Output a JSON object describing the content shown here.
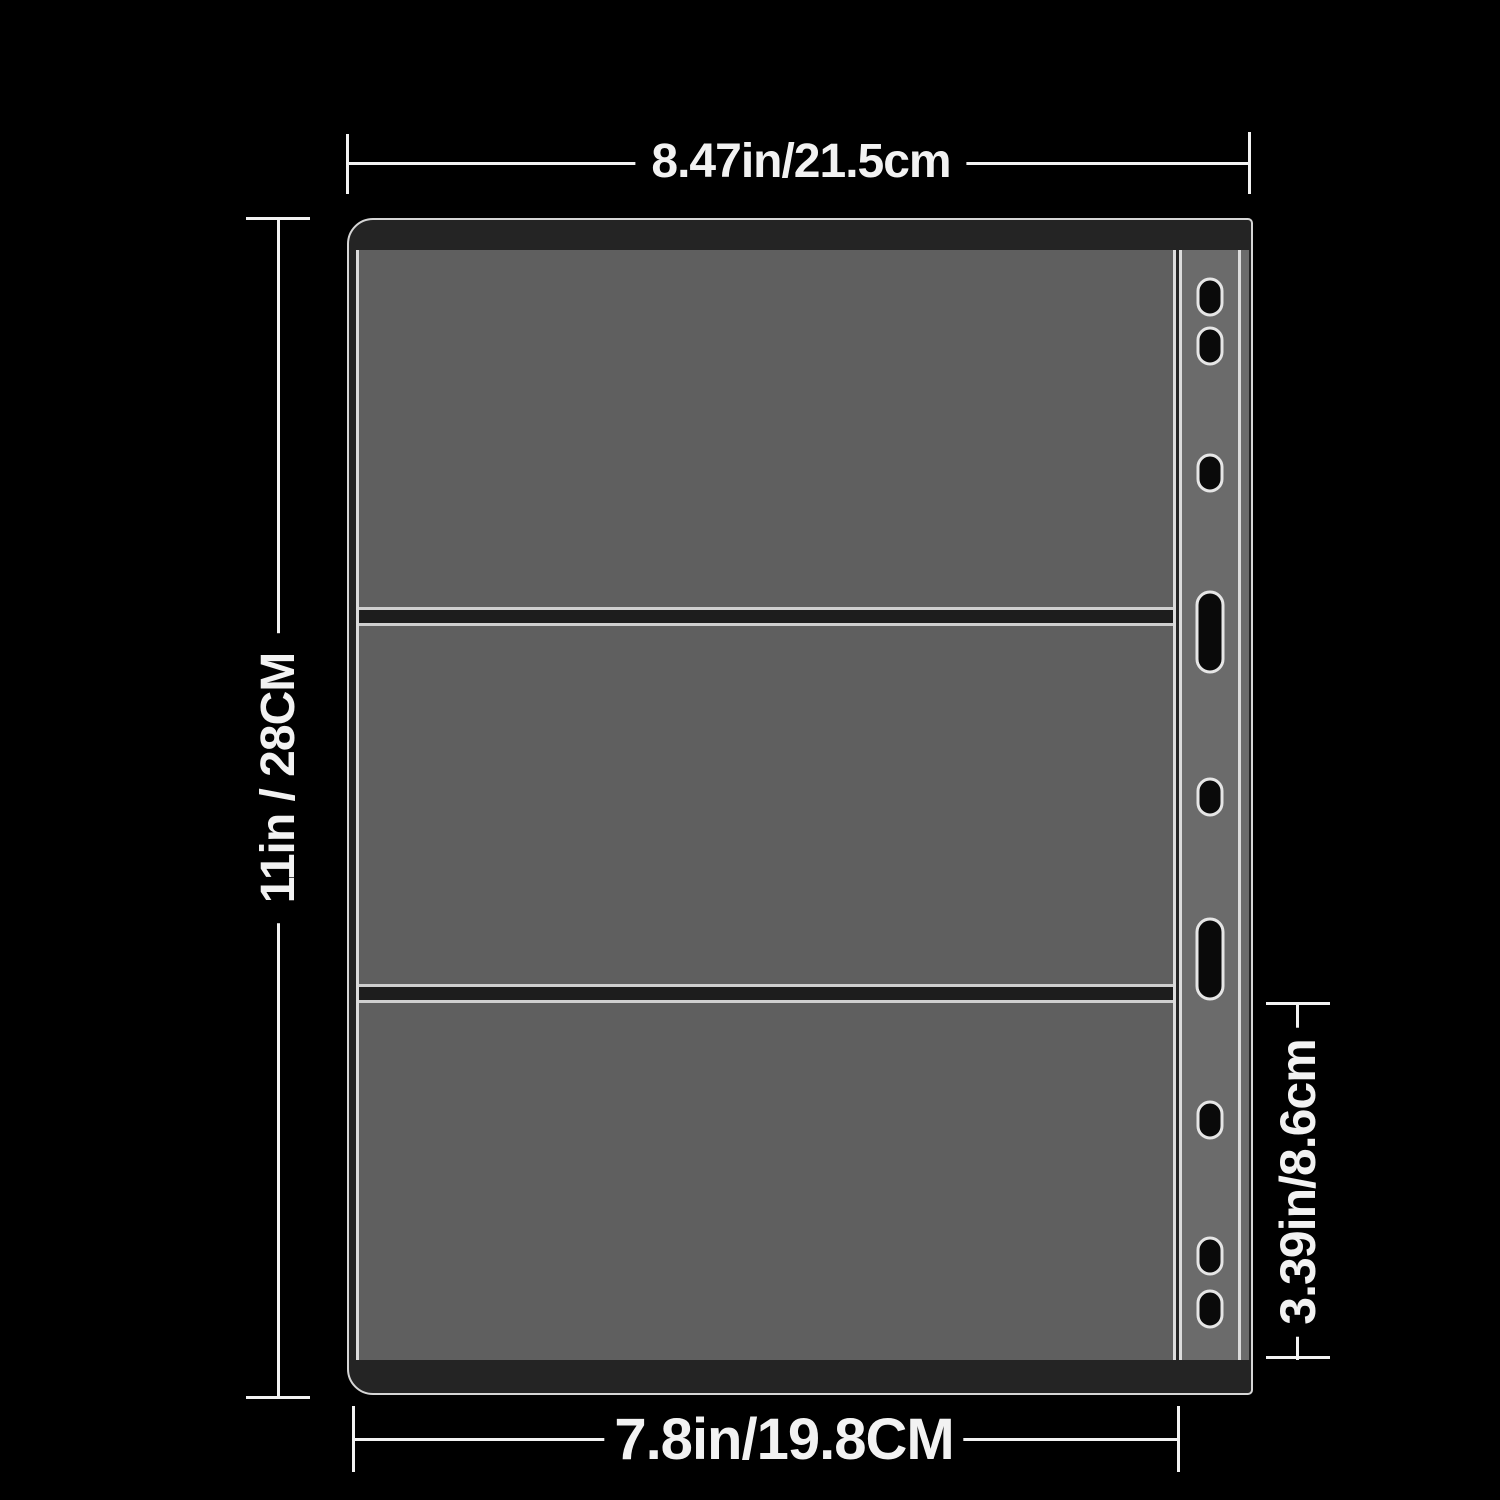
{
  "annotations": {
    "top_width": "8.47in/21.5cm",
    "left_height": "11in / 28CM",
    "right_pocket_height": "3.39in/8.6cm",
    "bottom_inner_width": "7.8in/19.8CM"
  },
  "page": {
    "pocket_count": 3,
    "binding_holes": [
      {
        "type": "small",
        "cy": 47
      },
      {
        "type": "small",
        "cy": 96
      },
      {
        "type": "small",
        "cy": 223
      },
      {
        "type": "slot",
        "cy": 382
      },
      {
        "type": "small",
        "cy": 547
      },
      {
        "type": "slot",
        "cy": 709
      },
      {
        "type": "small",
        "cy": 870
      },
      {
        "type": "small",
        "cy": 1006
      },
      {
        "type": "small",
        "cy": 1059
      }
    ]
  },
  "colors": {
    "background": "#000000",
    "page_outline": "#d6d6d6",
    "spine_strip": "#242424",
    "pocket_fill": "#5f5f5f",
    "binding_strip_fill": "#6b6b6b",
    "pocket_divider": "#1d1d1d",
    "hole_fill": "#0a0a0a",
    "dimension_lines_text": "#f2f2f2"
  }
}
